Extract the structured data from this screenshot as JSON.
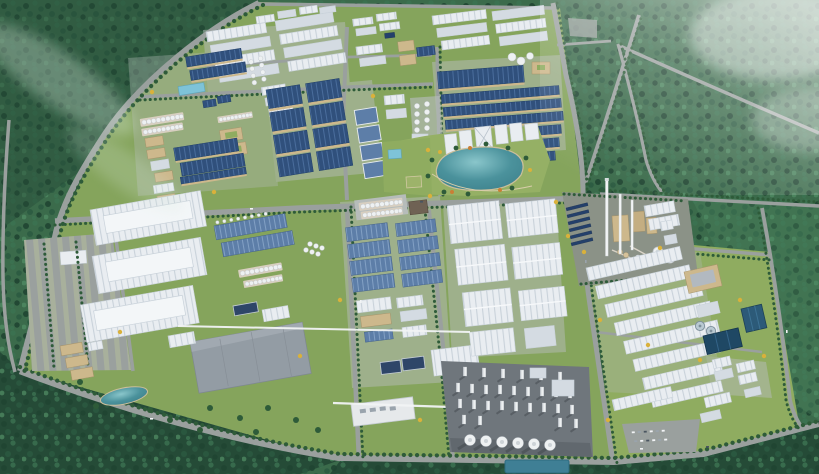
{
  "meta": {
    "description": "Aerial 3D architectural rendering of a large green industrial park: factory and warehouse clusters, a central landscaped lake, a cement plant with tall chimneys, a processing tower complex, water-treatment basins and tree-lined roads, all surrounded by dense forest with haze in the upper right.",
    "width": 819,
    "height": 474
  },
  "palette": {
    "forest_base": "#3b6b4b",
    "forest_dark": "#254b37",
    "forest_tex_dark": "#1f4431",
    "forest_tex_mid": "#2b5a41",
    "forest_tex_light": "#3b7251",
    "forest_tex_xlight": "#4d8760",
    "mist": "#d8e9dc",
    "haze": "#ffffff",
    "grass": "#85a45c",
    "grass_alt": "#8fac60",
    "park_green": "#95b065",
    "road": "#9aa09e",
    "road_dark": "#878d8c",
    "pad": "#b6bcba",
    "pad_dark": "#6f767c",
    "plant_pad": "#8b9287",
    "roof_white": "#e9edf1",
    "roof_white_line": "#c9d2da",
    "roof_white_dark": "#d4dbe2",
    "roof_blue": "#30507c",
    "roof_blue_line": "#4a6d9c",
    "roof_steel": "#5d7ea8",
    "roof_steel_line": "#82a0c4",
    "roof_gray": "#939ca4",
    "navy_flat": "#2e4668",
    "wall_tan": "#cdb88c",
    "wall_tan_dark": "#a7946b",
    "brown_roof": "#6f6254",
    "lake_deep": "#3d818c",
    "lake_mid": "#4b929c",
    "lake_light": "#8ac6cb",
    "pool_blue": "#7ec3d8",
    "basin_blue": "#2c5a78",
    "basin_dark": "#1f4864",
    "water_teal": "#3f7f95",
    "clarifier": "#b9c9d2",
    "tower_white": "#eef1f2",
    "tower_shade": "#c3c9ce",
    "shadow": "#3c4247",
    "tree_line": "#2e5b39",
    "tree_dark": "#1d4330",
    "tree_yellow": "#d9b13b",
    "tree_orange": "#c97f35",
    "solar": "#24406b",
    "chimney": "#f2f4f5",
    "silo_base": "#d8cfc0",
    "car_white": "#f2f4f6",
    "car_gray": "#9aa4ad",
    "car_dark": "#4a5560"
  },
  "scene": {
    "regions": [
      {
        "name": "forest-backdrop",
        "description": "dense green forest surrounding the park"
      },
      {
        "name": "haze-topright",
        "description": "white atmospheric haze over the north-east forest"
      },
      {
        "name": "industrial-park-grounds",
        "description": "main grassed industrial estate"
      },
      {
        "name": "east-industrial-district",
        "description": "second estate east of the main park"
      },
      {
        "name": "road-network",
        "description": "tree-lined boulevards and perimeter roads"
      },
      {
        "name": "west-parking-lot",
        "description": "striped surface parking on the west edge"
      },
      {
        "name": "north-white-factory-rows",
        "description": "rows of white flat factories, north-centre"
      },
      {
        "name": "northwest-factory-cluster",
        "description": "mixed tan/blue factories, tank and silo batteries"
      },
      {
        "name": "blue-roof-workshop-grid",
        "description": "grid of large navy-blue roofed workshops"
      },
      {
        "name": "central-workshop-rows",
        "description": "long blue-roofed workshop rows with tan walls"
      },
      {
        "name": "north-campus",
        "description": "small white building rows along the north boundary"
      },
      {
        "name": "lakeside-business-district",
        "description": "white office buildings around the lake"
      },
      {
        "name": "central-lake",
        "description": "turquoise landscaped lake with park ring"
      },
      {
        "name": "cement-plant",
        "description": "cement plant with tall white chimneys and cooling towers"
      },
      {
        "name": "east-warehouse-district",
        "description": "long white warehouse rows, east estate"
      },
      {
        "name": "water-treatment-plant",
        "description": "dark blue treatment basins and clarifiers"
      },
      {
        "name": "southeast-parking-lot",
        "description": "car park triangle in the south-east"
      },
      {
        "name": "processing-tower-complex",
        "description": "dense white towers and big silos on dark pad"
      },
      {
        "name": "mega-warehouse-block-southwest",
        "description": "three giant white logistics halls"
      },
      {
        "name": "gray-logistics-hall",
        "description": "large flat gray hall"
      },
      {
        "name": "southwest-pond",
        "description": "small teal pond in the south-west green"
      },
      {
        "name": "south-workshop-strip",
        "description": "steel-blue workshop columns south of centre"
      },
      {
        "name": "east-mega-warehouse-column",
        "description": "column of big white warehouses left of the tower complex"
      },
      {
        "name": "pipe-racks",
        "description": "white overhead pipe racks crossing the estate"
      },
      {
        "name": "silo-batteries",
        "description": "rows of white storage silos"
      }
    ]
  }
}
